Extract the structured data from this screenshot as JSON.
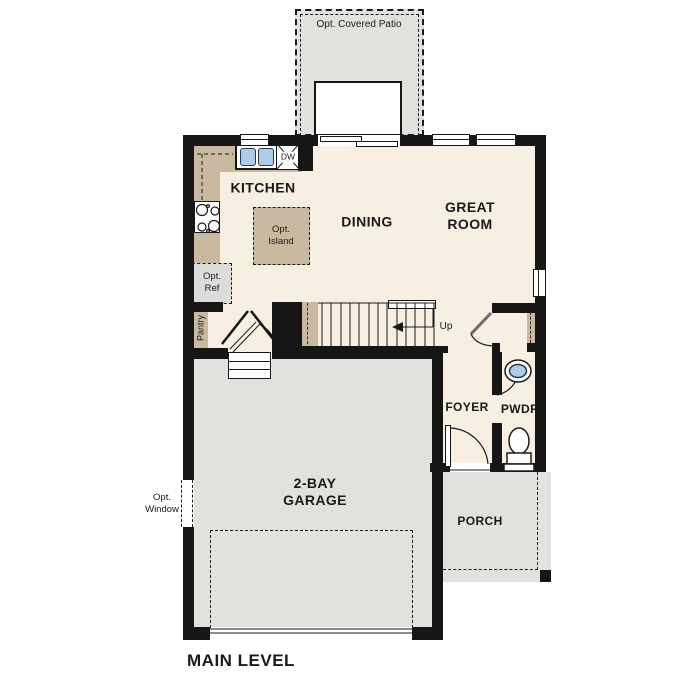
{
  "title": "MAIN LEVEL",
  "colors": {
    "wall": "#161616",
    "floor": "#f6efe2",
    "counter": "#c9b9a1",
    "concrete": "#e2e1de",
    "appliance": "#dcdcdb",
    "water": "#aecbe8",
    "line": "#1a1a1a",
    "paper": "#ffffff",
    "text": "#1a1a1a"
  },
  "rooms": {
    "kitchen": "KITCHEN",
    "dining": "DINING",
    "great_room": "GREAT\nROOM",
    "foyer": "FOYER",
    "powder": "PWDR",
    "garage": "2-BAY\nGARAGE",
    "porch": "PORCH",
    "pantry": "Pantry"
  },
  "options": {
    "covered_patio": "Opt. Covered Patio",
    "island": "Opt.\nIsland",
    "refrigerator": "Opt.\nRef",
    "window": "Opt.\nWindow"
  },
  "labels": {
    "up": "Up",
    "dishwasher": "DW"
  }
}
